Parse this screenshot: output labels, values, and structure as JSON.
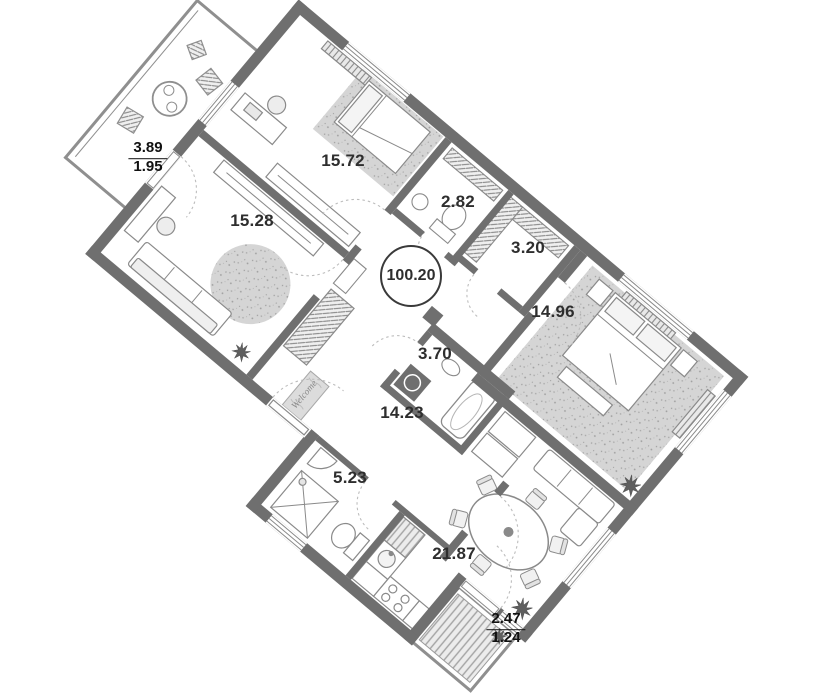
{
  "plan": {
    "total_area": "100.20",
    "rooms": [
      {
        "key": "bedroom-top",
        "area": "15.72"
      },
      {
        "key": "wc",
        "area": "2.82"
      },
      {
        "key": "storage",
        "area": "3.20"
      },
      {
        "key": "bedroom-right",
        "area": "14.96"
      },
      {
        "key": "living-room",
        "area": "15.28"
      },
      {
        "key": "bathroom",
        "area": "3.70"
      },
      {
        "key": "hallway",
        "area": "14.23"
      },
      {
        "key": "shower-room",
        "area": "5.23"
      },
      {
        "key": "kitchen-living",
        "area": "21.87"
      }
    ],
    "balconies": [
      {
        "key": "balcony-northwest",
        "area_full": "3.89",
        "area_reduced": "1.95"
      },
      {
        "key": "balcony-southeast",
        "area_full": "2.47",
        "area_reduced": "1.24"
      }
    ],
    "doormat_text": "Welcome",
    "colors": {
      "wall": "#6f6f6f",
      "furniture_line": "#8a8a8a",
      "carpet_fill": "#d6d6d6",
      "label_text": "#2e2e2e"
    }
  }
}
